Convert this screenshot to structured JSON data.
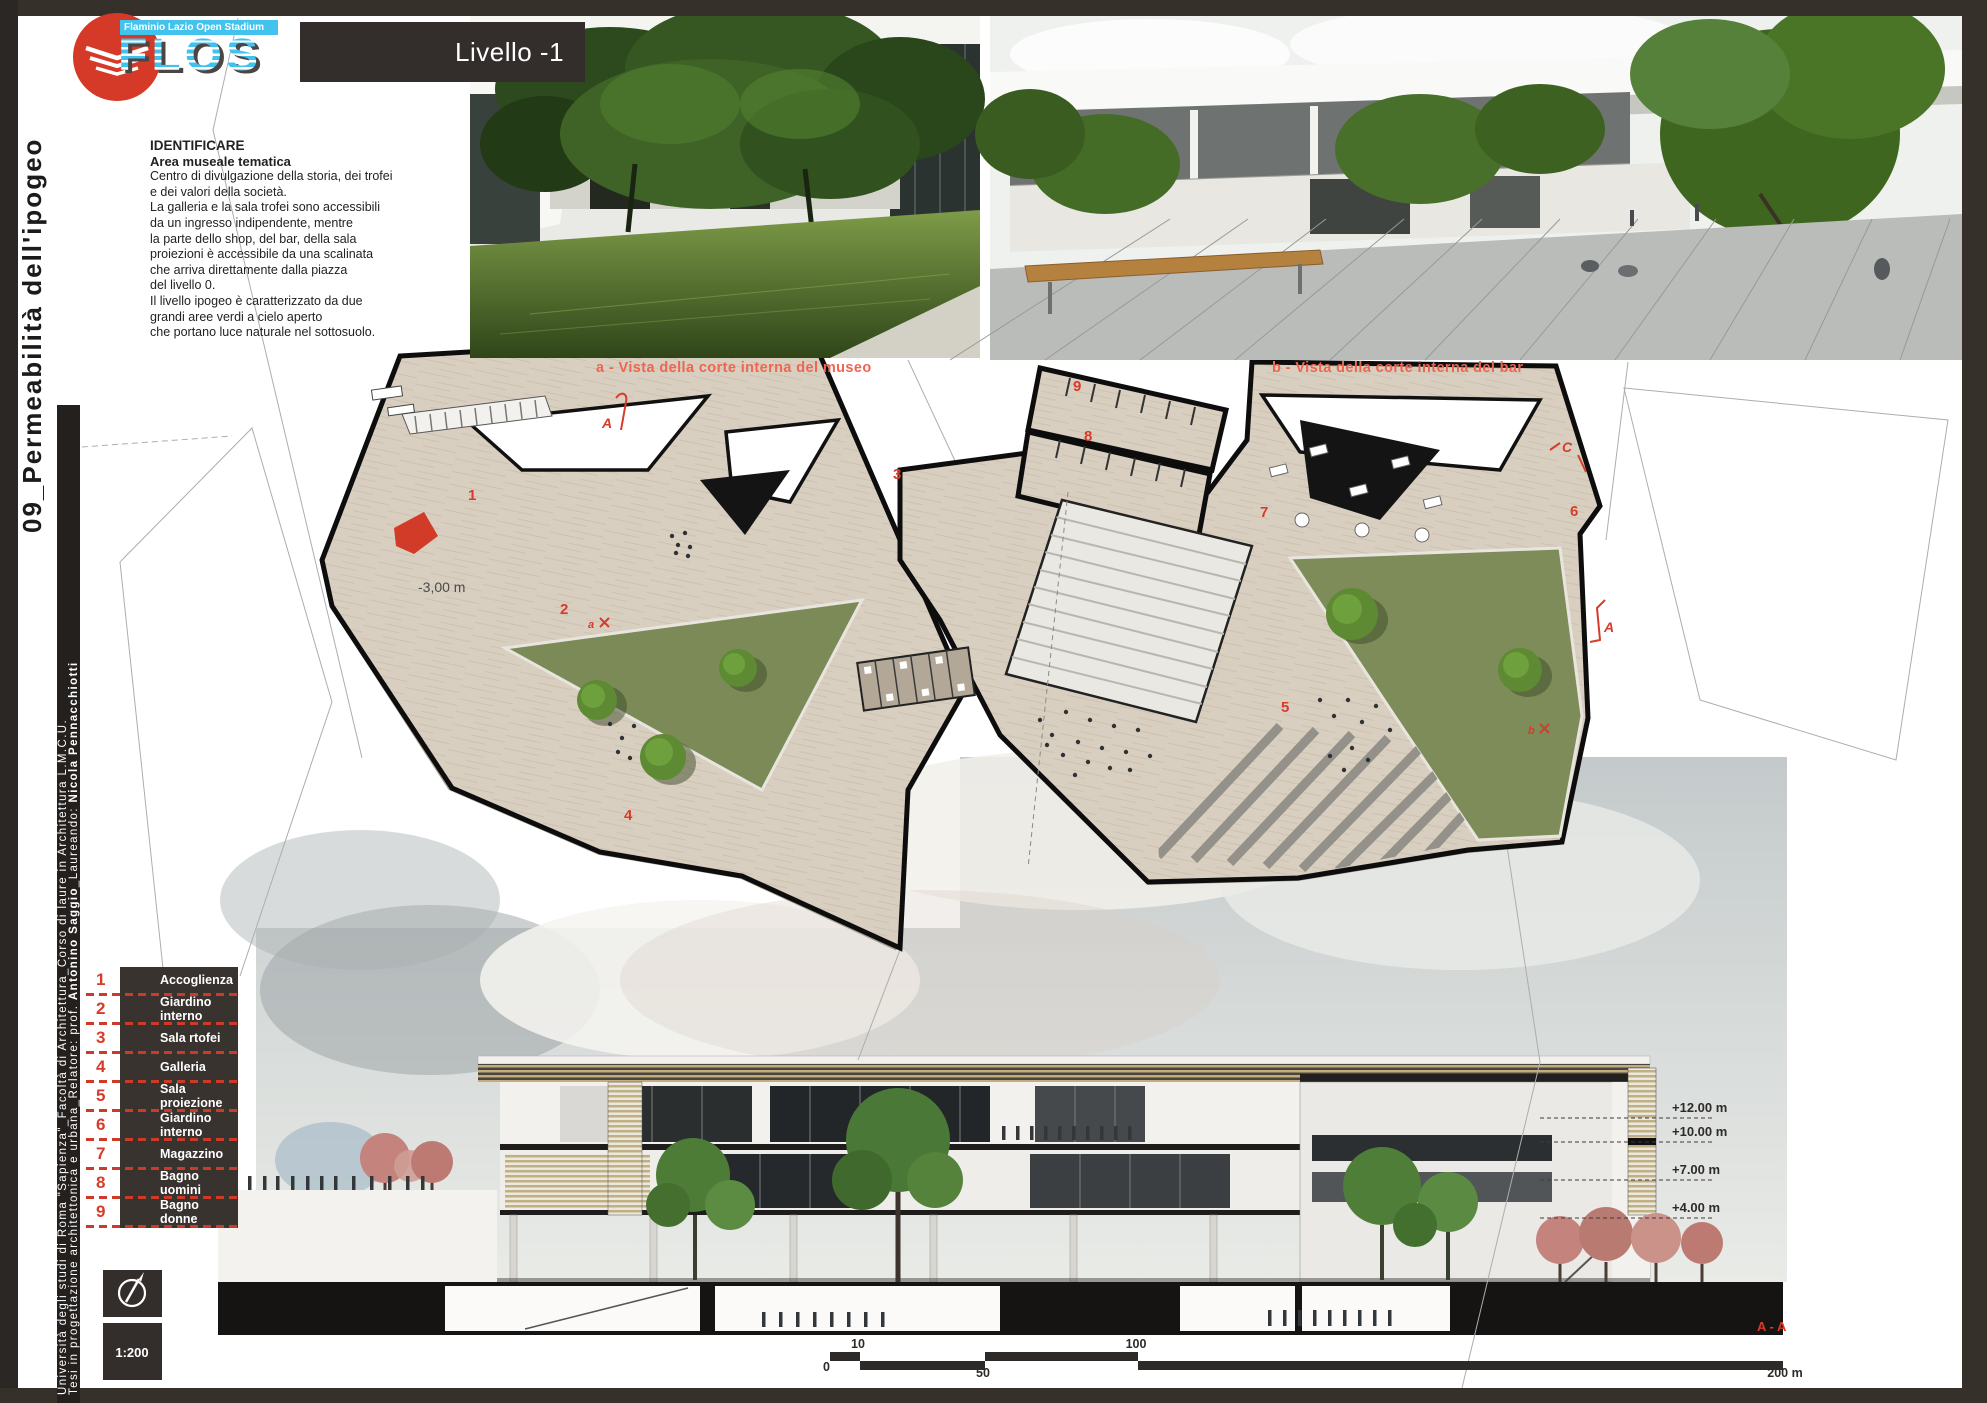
{
  "colors": {
    "accent_red": "#d73b2a",
    "caption_red": "#ee6550",
    "flos_cyan": "#41c3ee",
    "panel_dark": "#332e2b",
    "plan_floor": "#d8cec0",
    "courtyard_green": "#7b8a57"
  },
  "sidebar": {
    "sheet_title": "09_Permeabilità dell'ipogeo",
    "credit_line1": "Università degli studi di Roma \"Sapienza\"_Facoltà di Architettura_Corso di laure in Architettura L.M.C.U.",
    "credit_line2_pre": "Tesi in progettazione architettonica e urbana_Relatore: prof. ",
    "credit_line2_bold1": "Antonino Saggio",
    "credit_line2_mid": "_Laureando: ",
    "credit_line2_bold2": "Nicola Pennacchiotti"
  },
  "logo": {
    "banner": "Flaminio Lazio Open Stadium",
    "acronym": "FLOS"
  },
  "header": {
    "level_label": "Livello -1"
  },
  "description": {
    "title": "IDENTIFICARE",
    "subtitle": "Area museale tematica",
    "lines": [
      "Centro di divulgazione della storia, dei trofei",
      "e dei valori della società.",
      "La galleria e la sala trofei sono accessibili",
      "da un ingresso indipendente, mentre",
      "la parte dello shop, del bar, della sala",
      "proiezioni è accessibile da una scalinata",
      "che arriva direttamente dalla piazza",
      "del livello 0.",
      "Il livello ipogeo è caratterizzato da due",
      "grandi aree verdi a cielo aperto",
      "che portano luce naturale nel sottosuolo."
    ]
  },
  "renders": {
    "a": {
      "caption": "a - Vista della corte interna del museo"
    },
    "b": {
      "caption": "b - Vista della corte interna del bar"
    }
  },
  "plan": {
    "elevation_label": "-3,00 m",
    "room_numbers": [
      "1",
      "2",
      "3",
      "4",
      "5",
      "6",
      "7",
      "8",
      "9"
    ],
    "section_marker_top": "A",
    "section_marker_c": "C",
    "section_marker_right": "A",
    "camera_marker_a": "a",
    "camera_marker_b": "b"
  },
  "legend": {
    "items": [
      {
        "number": "1",
        "label": "Accoglienza"
      },
      {
        "number": "2",
        "label": "Giardino interno"
      },
      {
        "number": "3",
        "label": "Sala rtofei"
      },
      {
        "number": "4",
        "label": "Galleria"
      },
      {
        "number": "5",
        "label": "Sala proiezione"
      },
      {
        "number": "6",
        "label": "Giardino interno"
      },
      {
        "number": "7",
        "label": "Magazzino"
      },
      {
        "number": "8",
        "label": "Bagno uomini"
      },
      {
        "number": "9",
        "label": "Bagno donne"
      }
    ]
  },
  "section": {
    "elevations": [
      "+12.00 m",
      "+10.00 m",
      "+7.00 m",
      "+4.00 m"
    ],
    "cut_label": "A - A"
  },
  "scalebar": {
    "zero": "0",
    "ten": "10",
    "fifty": "50",
    "hundred": "100",
    "end": "200 m"
  },
  "scale_box": {
    "label": "1:200"
  }
}
